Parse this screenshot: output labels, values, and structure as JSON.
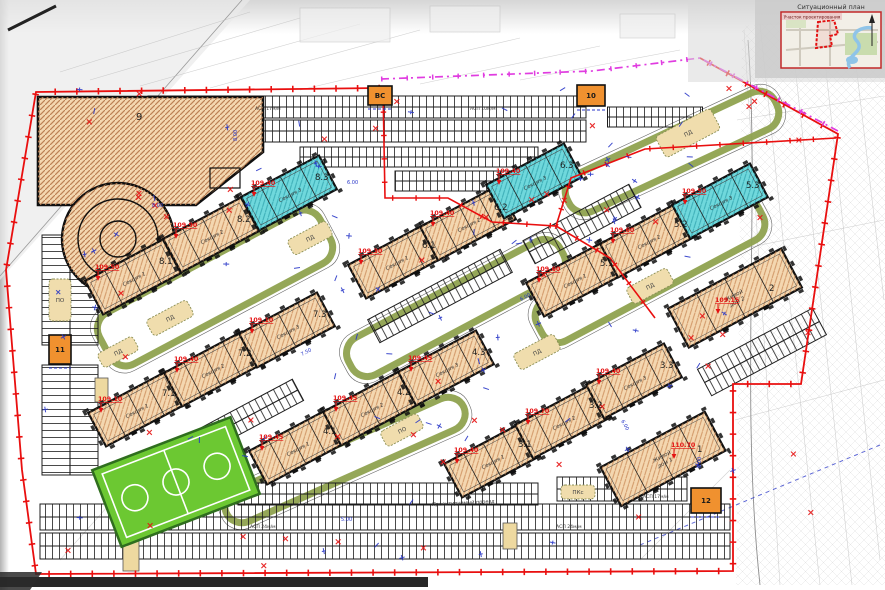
{
  "inset": {
    "title": "Ситуационный план",
    "area_label": "Участок проектирования"
  },
  "colors": {
    "boundary": "#e90f0f",
    "magenta": "#e03ce0",
    "tan": "#f4d7b0",
    "teal": "#6fd8dc",
    "orange": "#f0912f",
    "olive": "#8fa24f",
    "field_green": "#6cc832",
    "play": "#f0ddad",
    "blue": "#2836c8",
    "red": "#e51212"
  },
  "houses": [
    {
      "id": "8.1",
      "section": "Секция 1",
      "elev": "109.50",
      "color": "tan",
      "cx": 133,
      "cy": 277,
      "len": 88,
      "wid": 38,
      "angle": -28
    },
    {
      "id": "8.2",
      "section": "Секция 2",
      "elev": "109.90",
      "color": "tan",
      "cx": 211,
      "cy": 235,
      "len": 88,
      "wid": 38,
      "angle": -28
    },
    {
      "id": "8.3",
      "section": "Секция 3",
      "elev": "109.40",
      "color": "teal",
      "cx": 289,
      "cy": 193,
      "len": 88,
      "wid": 38,
      "angle": -28
    },
    {
      "id": "6.1",
      "section": "Секция 1",
      "elev": "109.30",
      "color": "tan",
      "cx": 396,
      "cy": 261,
      "len": 88,
      "wid": 38,
      "angle": -28
    },
    {
      "id": "6.2",
      "section": "Секция 2",
      "elev": "109.40",
      "color": "tan",
      "cx": 468,
      "cy": 223,
      "len": 88,
      "wid": 38,
      "angle": -28
    },
    {
      "id": "6.3",
      "section": "Секция 3",
      "elev": "109.40",
      "color": "teal",
      "cx": 534,
      "cy": 181,
      "len": 88,
      "wid": 38,
      "angle": -28
    },
    {
      "id": "5.1",
      "section": "Секция 1",
      "elev": "109.60",
      "color": "tan",
      "cx": 574,
      "cy": 279,
      "len": 88,
      "wid": 38,
      "angle": -28
    },
    {
      "id": "5.2",
      "section": "Секция 2",
      "elev": "109.60",
      "color": "tan",
      "cx": 648,
      "cy": 240,
      "len": 88,
      "wid": 38,
      "angle": -28
    },
    {
      "id": "5.3",
      "section": "Секция 3",
      "elev": "109.50",
      "color": "teal",
      "cx": 720,
      "cy": 201,
      "len": 88,
      "wid": 38,
      "angle": -28
    },
    {
      "id": "7.1",
      "section": "Секция 1",
      "elev": "109.10",
      "color": "tan",
      "cx": 136,
      "cy": 409,
      "len": 88,
      "wid": 38,
      "angle": -28
    },
    {
      "id": "7.2",
      "section": "Секция 2",
      "elev": "109.40",
      "color": "tan",
      "cx": 212,
      "cy": 369,
      "len": 88,
      "wid": 38,
      "angle": -28
    },
    {
      "id": "7.3",
      "section": "Секция 3",
      "elev": "109.10",
      "color": "tan",
      "cx": 287,
      "cy": 330,
      "len": 88,
      "wid": 38,
      "angle": -28
    },
    {
      "id": "4.1",
      "section": "Секция 1",
      "elev": "109.45",
      "color": "tan",
      "cx": 297,
      "cy": 447,
      "len": 88,
      "wid": 38,
      "angle": -28
    },
    {
      "id": "4.2",
      "section": "Секция 2",
      "elev": "109.45",
      "color": "tan",
      "cx": 371,
      "cy": 408,
      "len": 88,
      "wid": 38,
      "angle": -28
    },
    {
      "id": "4.3",
      "section": "Секция 3",
      "elev": "109.45",
      "color": "tan",
      "cx": 446,
      "cy": 368,
      "len": 88,
      "wid": 38,
      "angle": -28
    },
    {
      "id": "3.1",
      "section": "Секция 1",
      "elev": "109.40",
      "color": "tan",
      "cx": 492,
      "cy": 460,
      "len": 88,
      "wid": 38,
      "angle": -28
    },
    {
      "id": "3.2",
      "section": "Секция 2",
      "elev": "109.70",
      "color": "tan",
      "cx": 563,
      "cy": 421,
      "len": 88,
      "wid": 38,
      "angle": -28
    },
    {
      "id": "3.3",
      "section": "Секция 3",
      "elev": "109.40",
      "color": "tan",
      "cx": 634,
      "cy": 381,
      "len": 88,
      "wid": 38,
      "angle": -28
    },
    {
      "id": "2",
      "name": "Жилой дом 2",
      "elev": "109.15",
      "color": "tan",
      "cx": 735,
      "cy": 298,
      "len": 128,
      "wid": 44,
      "angle": -28
    },
    {
      "id": "1",
      "name": "Жилой дом 1",
      "elev": "110.70",
      "color": "tan",
      "cx": 663,
      "cy": 459,
      "len": 118,
      "wid": 44,
      "angle": -28
    }
  ],
  "garage": {
    "label": "9"
  },
  "service": [
    {
      "label": "ВС",
      "x": 368,
      "y": 86,
      "w": 24,
      "h": 19
    },
    {
      "label": "10",
      "x": 577,
      "y": 85,
      "w": 28,
      "h": 21
    },
    {
      "label": "11",
      "x": 49,
      "y": 335,
      "w": 22,
      "h": 29
    },
    {
      "label": "12",
      "x": 691,
      "y": 488,
      "w": 30,
      "h": 25
    }
  ],
  "playgrounds": [
    {
      "label": "ПД",
      "cx": 170,
      "cy": 318,
      "w": 46,
      "h": 18,
      "angle": -28
    },
    {
      "label": "ПД",
      "cx": 118,
      "cy": 352,
      "w": 40,
      "h": 16,
      "angle": -28
    },
    {
      "label": "ПД",
      "cx": 310,
      "cy": 238,
      "w": 44,
      "h": 17,
      "angle": -28
    },
    {
      "label": "ПД",
      "cx": 537,
      "cy": 352,
      "w": 46,
      "h": 18,
      "angle": -28
    },
    {
      "label": "ПД",
      "cx": 650,
      "cy": 286,
      "w": 46,
      "h": 18,
      "angle": -28
    },
    {
      "label": "ПД",
      "cx": 688,
      "cy": 133,
      "w": 62,
      "h": 24,
      "angle": -28
    },
    {
      "label": "ПО",
      "cx": 402,
      "cy": 430,
      "w": 42,
      "h": 17,
      "angle": -28
    },
    {
      "label": "ПО",
      "cx": 60,
      "cy": 300,
      "w": 22,
      "h": 42,
      "angle": 0
    },
    {
      "label": "ПКс",
      "cx": 578,
      "cy": 492,
      "w": 34,
      "h": 14,
      "angle": 0
    }
  ],
  "parking_labels": [
    {
      "text": "АСП 17м/м",
      "x": 255,
      "y": 110,
      "r": 0
    },
    {
      "text": "АСП 10м/м",
      "x": 470,
      "y": 110,
      "r": 0
    },
    {
      "text": "АСП 24м/м",
      "x": 250,
      "y": 528,
      "r": 0
    },
    {
      "text": "АСП 24м/м",
      "x": 556,
      "y": 528,
      "r": 0
    },
    {
      "text": "АСП 17м/м",
      "x": 643,
      "y": 498,
      "r": 0
    }
  ],
  "road_label": {
    "text": "Проектируемый проезд",
    "x": 432,
    "y": 506,
    "r": -3
  },
  "dim_labels": [
    {
      "text": "8.00",
      "x": 237,
      "y": 141,
      "r": -90
    },
    {
      "text": "6.00",
      "x": 347,
      "y": 184,
      "r": 0
    },
    {
      "text": "7.50",
      "x": 302,
      "y": 356,
      "r": -28
    },
    {
      "text": "6.00",
      "x": 521,
      "y": 301,
      "r": -28
    },
    {
      "text": "6.00",
      "x": 621,
      "y": 421,
      "r": 61
    },
    {
      "text": "8.00",
      "x": 152,
      "y": 207,
      "r": 0
    },
    {
      "text": "5.00",
      "x": 341,
      "y": 521,
      "r": 0
    },
    {
      "text": "6.00",
      "x": 701,
      "y": 468,
      "r": -90
    }
  ]
}
